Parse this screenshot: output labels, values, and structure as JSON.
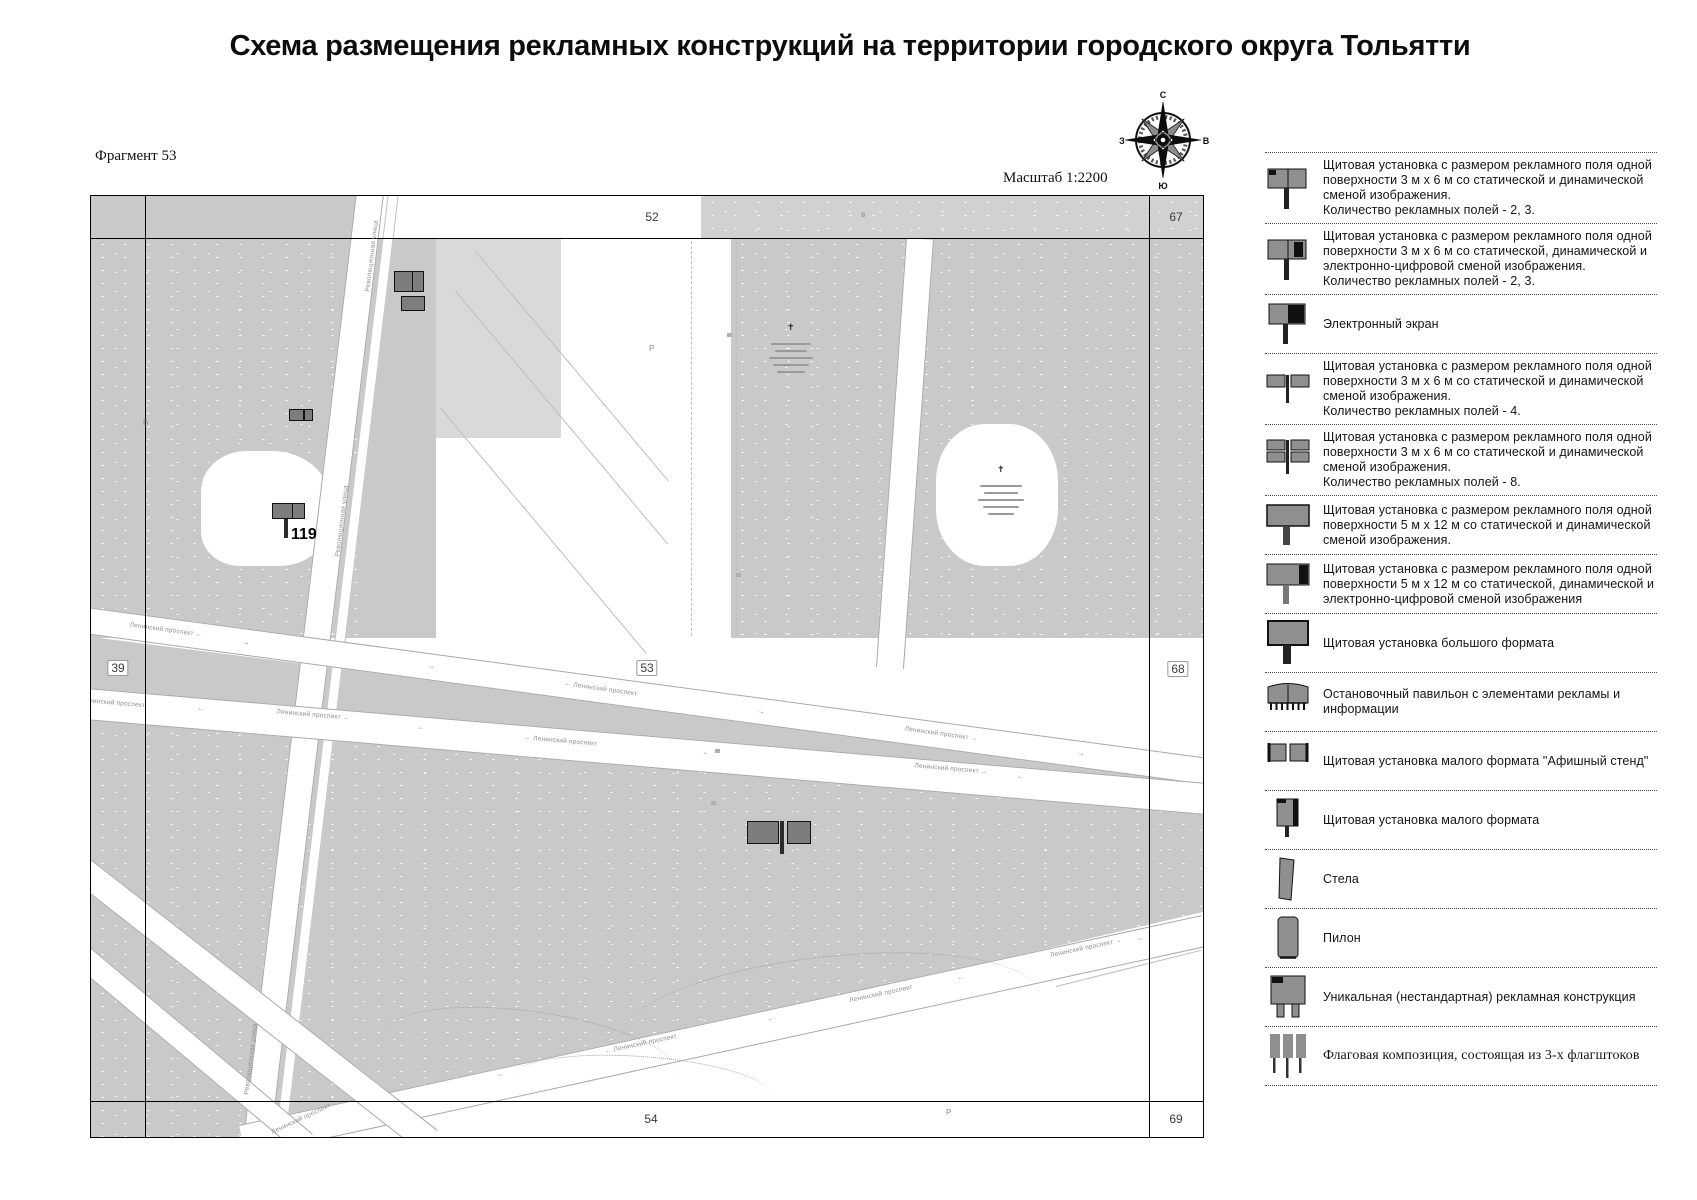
{
  "title": "Схема размещения рекламных конструкций на территории городского округа Тольятти",
  "map": {
    "fragment_label": "Фрагмент 53",
    "scale_label": "Масштаб 1:2200",
    "compass": {
      "north": "С",
      "south": "Ю",
      "west": "З",
      "east": "В"
    },
    "grid_numbers": [
      {
        "text": "52",
        "x": 561,
        "y": 21,
        "boxed": false
      },
      {
        "text": "67",
        "x": 1085,
        "y": 21,
        "boxed": false
      },
      {
        "text": "39",
        "x": 27,
        "y": 472,
        "boxed": true
      },
      {
        "text": "53",
        "x": 556,
        "y": 472,
        "boxed": true
      },
      {
        "text": "68",
        "x": 1087,
        "y": 473,
        "boxed": true
      },
      {
        "text": "54",
        "x": 560,
        "y": 923,
        "boxed": false
      },
      {
        "text": "69",
        "x": 1085,
        "y": 923,
        "boxed": false
      }
    ],
    "street_labels": [
      {
        "text": "Революционная улица",
        "x": 281,
        "y": 60,
        "rot": -83
      },
      {
        "text": "Революционная улица",
        "x": 251,
        "y": 325,
        "rot": -83
      },
      {
        "text": "Революционная улица",
        "x": 160,
        "y": 863,
        "rot": -83
      },
      {
        "text": "Ленинский проспект ←",
        "x": 75,
        "y": 434,
        "rot": 8
      },
      {
        "text": "← Ленинский проспект",
        "x": 510,
        "y": 493,
        "rot": 8
      },
      {
        "text": "Ленинский проспект →",
        "x": 850,
        "y": 538,
        "rot": 8
      },
      {
        "text": "Ленинский проспект",
        "x": 22,
        "y": 507,
        "rot": 5
      },
      {
        "text": "Ленинский проспект →",
        "x": 222,
        "y": 519,
        "rot": 5
      },
      {
        "text": "← Ленинский проспект",
        "x": 470,
        "y": 545,
        "rot": 5
      },
      {
        "text": "Ленинский проспект →",
        "x": 860,
        "y": 573,
        "rot": 5
      },
      {
        "text": "← Ленинский проспект",
        "x": 550,
        "y": 848,
        "rot": -12
      },
      {
        "text": "Ленинский проспект",
        "x": 790,
        "y": 798,
        "rot": -12
      },
      {
        "text": "Ленинский проспект →",
        "x": 995,
        "y": 752,
        "rot": -12
      },
      {
        "text": "Ленинский проспект",
        "x": 210,
        "y": 923,
        "rot": -25
      },
      {
        "text": "→",
        "x": 155,
        "y": 446,
        "rot": 8,
        "arrow": true
      },
      {
        "text": "→",
        "x": 340,
        "y": 470,
        "rot": 8,
        "arrow": true
      },
      {
        "text": "→",
        "x": 670,
        "y": 515,
        "rot": 8,
        "arrow": true
      },
      {
        "text": "→",
        "x": 990,
        "y": 557,
        "rot": 8,
        "arrow": true
      },
      {
        "text": "←",
        "x": 110,
        "y": 512,
        "rot": 5,
        "arrow": true
      },
      {
        "text": "←",
        "x": 330,
        "y": 531,
        "rot": 5,
        "arrow": true
      },
      {
        "text": "←",
        "x": 615,
        "y": 556,
        "rot": 5,
        "arrow": true
      },
      {
        "text": "←",
        "x": 930,
        "y": 580,
        "rot": 5,
        "arrow": true
      },
      {
        "text": "←",
        "x": 410,
        "y": 878,
        "rot": -12,
        "arrow": true
      },
      {
        "text": "←",
        "x": 680,
        "y": 822,
        "rot": -12,
        "arrow": true
      },
      {
        "text": "←",
        "x": 870,
        "y": 781,
        "rot": -12,
        "arrow": true
      },
      {
        "text": "←",
        "x": 1050,
        "y": 742,
        "rot": -12,
        "arrow": true
      }
    ],
    "tiny_letters": [
      {
        "text": "в",
        "x": 770,
        "y": 14
      },
      {
        "text": "Б",
        "x": 52,
        "y": 222
      },
      {
        "text": "Р",
        "x": 855,
        "y": 912
      },
      {
        "text": "Р",
        "x": 558,
        "y": 148
      }
    ],
    "billboards": [
      {
        "x": 303,
        "y": 75,
        "w": 30,
        "h": 21,
        "divider": true
      },
      {
        "x": 310,
        "y": 100,
        "w": 24,
        "h": 15,
        "divider": false
      },
      {
        "x": 198,
        "y": 213,
        "w": 24,
        "h": 12,
        "divider": true
      },
      {
        "x": 181,
        "y": 307,
        "w": 33,
        "h": 16,
        "divider": true,
        "pole": {
          "x": 193,
          "y": 323,
          "w": 4,
          "h": 19
        },
        "label": "119",
        "label_x": 200,
        "label_y": 330
      },
      {
        "x": 656,
        "y": 625,
        "w": 32,
        "h": 23,
        "divider": false
      },
      {
        "x": 696,
        "y": 625,
        "w": 24,
        "h": 23,
        "divider": false,
        "pole": {
          "x": 689,
          "y": 625,
          "w": 4,
          "h": 33
        }
      }
    ]
  },
  "legend": {
    "items": [
      {
        "icon": "billboard-3x6-icon",
        "text": "Щитовая установка с размером рекламного поля одной поверхности 3 м х 6 м со статической и динамической сменой изображения.\nКоличество рекламных полей - 2, 3."
      },
      {
        "icon": "billboard-3x6-digital-icon",
        "text": "Щитовая установка с размером рекламного поля одной поверхности 3 м х 6 м со статической, динамической и электронно-цифровой сменой изображения.\nКоличество рекламных полей - 2, 3."
      },
      {
        "icon": "electronic-screen-icon",
        "text": "Электронный экран"
      },
      {
        "icon": "billboard-4-fields-icon",
        "text": "Щитовая установка с размером рекламного поля одной поверхности 3 м х 6 м со статической и динамической сменой изображения.\nКоличество рекламных полей - 4."
      },
      {
        "icon": "billboard-8-fields-icon",
        "text": "Щитовая установка с размером рекламного поля одной поверхности 3 м х 6 м со статической и динамической сменой изображения.\nКоличество рекламных полей - 8."
      },
      {
        "icon": "billboard-5x12-icon",
        "text": "Щитовая установка с размером рекламного поля одной поверхности 5 м х 12 м со статической и динамической сменой изображения."
      },
      {
        "icon": "billboard-5x12-digital-icon",
        "text": "Щитовая установка с размером рекламного поля одной поверхности 5 м х 12 м со статической, динамической и электронно-цифровой сменой изображения"
      },
      {
        "icon": "large-format-billboard-icon",
        "text": "Щитовая установка большого формата"
      },
      {
        "icon": "bus-shelter-icon",
        "text": "Остановочный павильон с элементами рекламы и информации"
      },
      {
        "icon": "poster-stand-icon",
        "text": "Щитовая установка малого формата \"Афишный стенд\""
      },
      {
        "icon": "small-format-billboard-icon",
        "text": "Щитовая установка малого формата"
      },
      {
        "icon": "stela-icon",
        "text": "Стела"
      },
      {
        "icon": "pylon-icon",
        "text": "Пилон"
      },
      {
        "icon": "unique-construction-icon",
        "text": "Уникальная (нестандартная) рекламная конструкция"
      },
      {
        "icon": "flag-composition-icon",
        "text": "Флаговая композиция, состоящая из 3-х флагштоков",
        "serif": true
      }
    ]
  }
}
